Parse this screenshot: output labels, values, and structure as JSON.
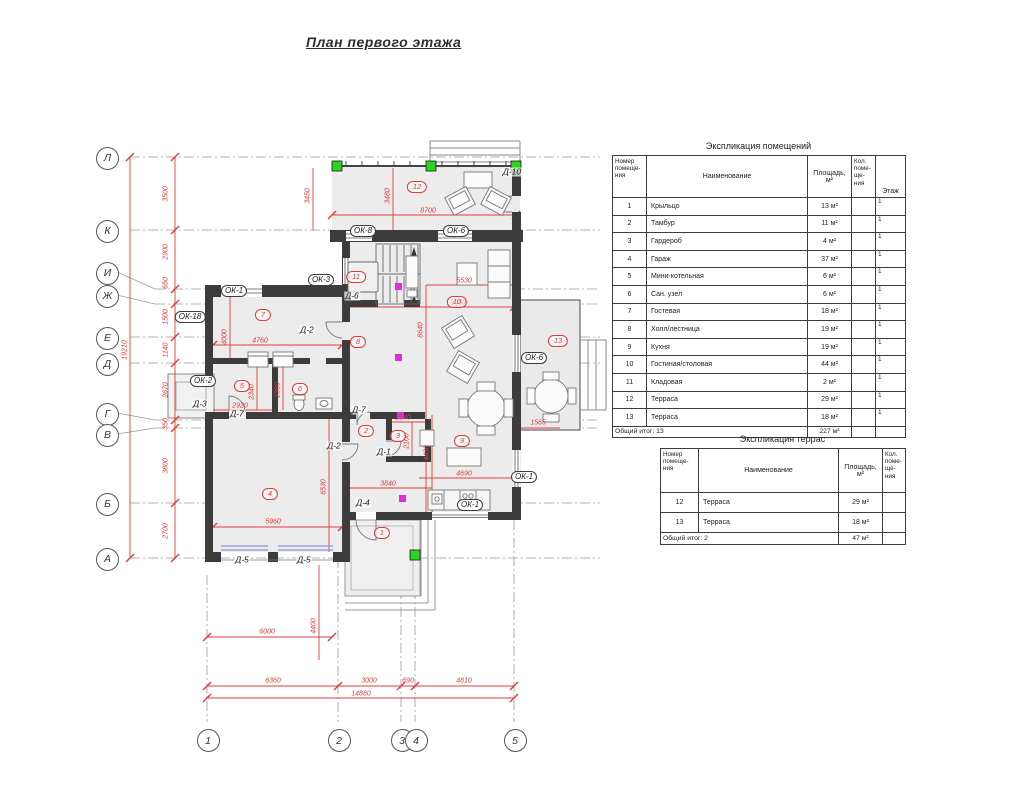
{
  "title": "План первого этажа",
  "room_table": {
    "title": "Экспликация помещений",
    "headers": {
      "num": "Номер помеще- ния",
      "name": "Наименование",
      "area": "Площадь, м²",
      "count": "Кол. поме- ще- ния",
      "floor": "Этаж"
    },
    "rows": [
      {
        "num": "1",
        "name": "Крыльцо",
        "area": "13 м²",
        "floor": "1"
      },
      {
        "num": "2",
        "name": "Тамбур",
        "area": "11 м²",
        "floor": "1"
      },
      {
        "num": "3",
        "name": "Гардероб",
        "area": "4 м²",
        "floor": "1"
      },
      {
        "num": "4",
        "name": "Гараж",
        "area": "37 м²",
        "floor": "1"
      },
      {
        "num": "5",
        "name": "Мини-котельная",
        "area": "6 м²",
        "floor": "1"
      },
      {
        "num": "6",
        "name": "Сан. узел",
        "area": "6 м²",
        "floor": "1"
      },
      {
        "num": "7",
        "name": "Гостевая",
        "area": "18 м²",
        "floor": "1"
      },
      {
        "num": "8",
        "name": "Холл/лестница",
        "area": "19 м²",
        "floor": "1"
      },
      {
        "num": "9",
        "name": "Кухня",
        "area": "19 м²",
        "floor": "1"
      },
      {
        "num": "10",
        "name": "Гостиная/столовая",
        "area": "44 м²",
        "floor": "1"
      },
      {
        "num": "11",
        "name": "Кладовая",
        "area": "2 м²",
        "floor": "1"
      },
      {
        "num": "12",
        "name": "Терраса",
        "area": "29 м²",
        "floor": "1"
      },
      {
        "num": "13",
        "name": "Терраса",
        "area": "18 м²",
        "floor": "1"
      }
    ],
    "total_label": "Общий итог: 13",
    "total_area": "227 м²"
  },
  "terrace_table": {
    "title": "Экспликация террас",
    "headers": {
      "num": "Номер помеще- ния",
      "name": "Наименование",
      "area": "Площадь, м²",
      "count": "Кол. поме- ще- ния"
    },
    "rows": [
      {
        "num": "12",
        "name": "Терраса",
        "area": "29 м²"
      },
      {
        "num": "13",
        "name": "Терраса",
        "area": "18 м²"
      }
    ],
    "total_label": "Общий итог: 2",
    "total_area": "47 м²"
  },
  "plan": {
    "colors": {
      "dimension": "#e23b3b",
      "wall": "#3c3c3c",
      "column_green": "#2bd41f",
      "vent_magenta": "#e32ae3"
    },
    "axes_left": [
      {
        "label": "Л",
        "y": 157
      },
      {
        "label": "К",
        "y": 230
      },
      {
        "label": "И",
        "y": 272
      },
      {
        "label": "Ж",
        "y": 295
      },
      {
        "label": "Е",
        "y": 337
      },
      {
        "label": "Д",
        "y": 363
      },
      {
        "label": "Г",
        "y": 413
      },
      {
        "label": "В",
        "y": 434
      },
      {
        "label": "Б",
        "y": 503
      },
      {
        "label": "А",
        "y": 558
      }
    ],
    "axes_bottom": [
      {
        "label": "1",
        "x": 207
      },
      {
        "label": "2",
        "x": 338
      },
      {
        "label": "3",
        "x": 401
      },
      {
        "label": "4",
        "x": 415
      },
      {
        "label": "5",
        "x": 514
      }
    ],
    "dims": [
      {
        "t": "3500",
        "x": 166,
        "y": 194,
        "r": 1
      },
      {
        "t": "2900",
        "x": 166,
        "y": 252,
        "r": 1
      },
      {
        "t": "650",
        "x": 166,
        "y": 283,
        "r": 1
      },
      {
        "t": "1500",
        "x": 166,
        "y": 317,
        "r": 1
      },
      {
        "t": "1140",
        "x": 166,
        "y": 350,
        "r": 1
      },
      {
        "t": "2670",
        "x": 166,
        "y": 390,
        "r": 1
      },
      {
        "t": "350",
        "x": 166,
        "y": 424,
        "r": 1
      },
      {
        "t": "3800",
        "x": 166,
        "y": 466,
        "r": 1
      },
      {
        "t": "2700",
        "x": 166,
        "y": 531,
        "r": 1
      },
      {
        "t": "19210",
        "x": 125,
        "y": 350,
        "r": 1
      },
      {
        "t": "6360",
        "x": 273,
        "y": 681,
        "r": 0
      },
      {
        "t": "3000",
        "x": 369,
        "y": 681,
        "r": 0
      },
      {
        "t": "690",
        "x": 408,
        "y": 681,
        "r": 0
      },
      {
        "t": "4810",
        "x": 464,
        "y": 681,
        "r": 0
      },
      {
        "t": "14860",
        "x": 361,
        "y": 694,
        "r": 0
      },
      {
        "t": "6000",
        "x": 267,
        "y": 632,
        "r": 0
      },
      {
        "t": "4400",
        "x": 314,
        "y": 626,
        "r": 1
      },
      {
        "t": "3450",
        "x": 308,
        "y": 196,
        "r": 1
      },
      {
        "t": "3480",
        "x": 388,
        "y": 196,
        "r": 1
      },
      {
        "t": "8700",
        "x": 428,
        "y": 211,
        "r": 0
      },
      {
        "t": "9880",
        "x": 458,
        "y": 303,
        "r": 0
      },
      {
        "t": "5530",
        "x": 464,
        "y": 281,
        "r": 0
      },
      {
        "t": "8640",
        "x": 421,
        "y": 330,
        "r": 1
      },
      {
        "t": "4000",
        "x": 225,
        "y": 337,
        "r": 1
      },
      {
        "t": "4760",
        "x": 260,
        "y": 341,
        "r": 0
      },
      {
        "t": "2920",
        "x": 240,
        "y": 406,
        "r": 0
      },
      {
        "t": "2340",
        "x": 252,
        "y": 392,
        "r": 1
      },
      {
        "t": "2360",
        "x": 278,
        "y": 390,
        "r": 1
      },
      {
        "t": "5960",
        "x": 273,
        "y": 522,
        "r": 0
      },
      {
        "t": "6530",
        "x": 324,
        "y": 487,
        "r": 1
      },
      {
        "t": "1540",
        "x": 403,
        "y": 418,
        "r": 0
      },
      {
        "t": "2100",
        "x": 407,
        "y": 441,
        "r": 1
      },
      {
        "t": "4430",
        "x": 427,
        "y": 453,
        "r": 1
      },
      {
        "t": "4690",
        "x": 464,
        "y": 474,
        "r": 0
      },
      {
        "t": "3840",
        "x": 388,
        "y": 484,
        "r": 0
      },
      {
        "t": "1565",
        "x": 538,
        "y": 423,
        "r": 0
      }
    ],
    "room_badges": [
      {
        "t": "1",
        "x": 382,
        "y": 533
      },
      {
        "t": "2",
        "x": 366,
        "y": 431
      },
      {
        "t": "3",
        "x": 398,
        "y": 436
      },
      {
        "t": "4",
        "x": 270,
        "y": 494
      },
      {
        "t": "5",
        "x": 242,
        "y": 386
      },
      {
        "t": "6",
        "x": 300,
        "y": 389
      },
      {
        "t": "7",
        "x": 263,
        "y": 315
      },
      {
        "t": "8",
        "x": 358,
        "y": 342
      },
      {
        "t": "9",
        "x": 462,
        "y": 441
      },
      {
        "t": "10",
        "x": 457,
        "y": 302
      },
      {
        "t": "11",
        "x": 356,
        "y": 277
      },
      {
        "t": "12",
        "x": 417,
        "y": 187
      },
      {
        "t": "13",
        "x": 558,
        "y": 341
      }
    ],
    "window_labels": [
      {
        "t": "ОК-8",
        "x": 363,
        "y": 231
      },
      {
        "t": "ОК-6",
        "x": 456,
        "y": 231
      },
      {
        "t": "ОК-3",
        "x": 321,
        "y": 280
      },
      {
        "t": "ОК-1",
        "x": 234,
        "y": 291
      },
      {
        "t": "ОК-18",
        "x": 190,
        "y": 317
      },
      {
        "t": "ОК-2",
        "x": 203,
        "y": 381
      },
      {
        "t": "ОК-6",
        "x": 534,
        "y": 358
      },
      {
        "t": "ОК-1",
        "x": 524,
        "y": 477
      },
      {
        "t": "ОК-1",
        "x": 470,
        "y": 505
      }
    ],
    "door_labels": [
      {
        "t": "Д-10",
        "x": 512,
        "y": 172
      },
      {
        "t": "Д-6",
        "x": 352,
        "y": 296
      },
      {
        "t": "Д-2",
        "x": 307,
        "y": 330
      },
      {
        "t": "Д-3",
        "x": 200,
        "y": 404
      },
      {
        "t": "Д-7",
        "x": 237,
        "y": 414
      },
      {
        "t": "Д-7",
        "x": 359,
        "y": 410
      },
      {
        "t": "Д-2",
        "x": 334,
        "y": 446
      },
      {
        "t": "Д-1",
        "x": 384,
        "y": 452
      },
      {
        "t": "Д-4",
        "x": 363,
        "y": 503
      },
      {
        "t": "Д-5",
        "x": 242,
        "y": 560
      },
      {
        "t": "Д-5",
        "x": 304,
        "y": 560
      }
    ]
  }
}
